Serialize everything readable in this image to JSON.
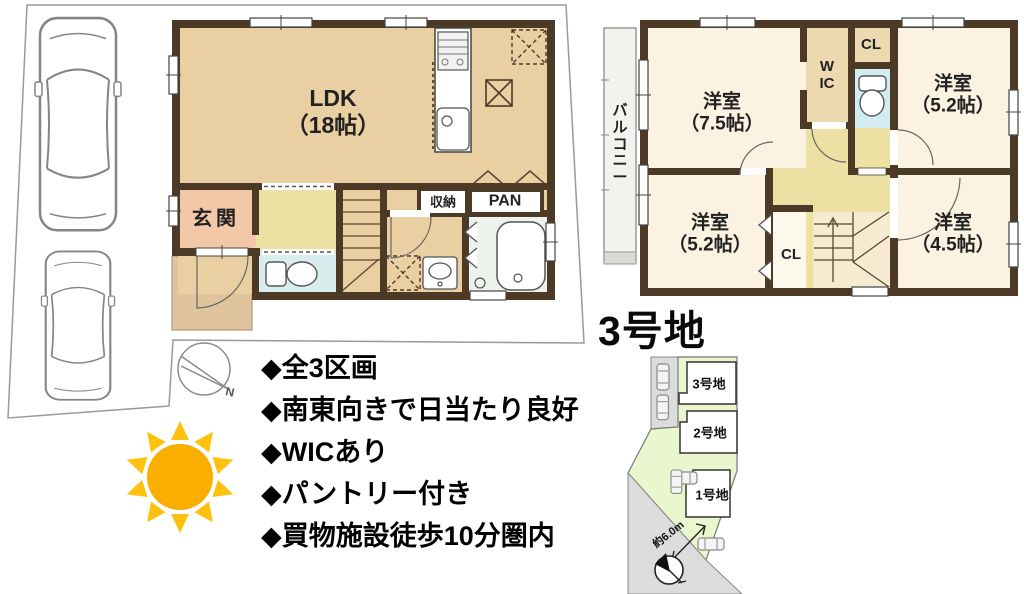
{
  "title": "3号地",
  "floor1": {
    "ldk_name": "LDK",
    "ldk_size": "（18帖）",
    "entrance": "玄関",
    "storage": "収納",
    "pantry": "PAN"
  },
  "floor2": {
    "balcony": "バルコニー",
    "wic": "WIC",
    "closet_top": "CL",
    "closet_bottom": "CL",
    "rooms": [
      {
        "name": "洋室",
        "size": "（7.5帖）"
      },
      {
        "name": "洋室",
        "size": "（5.2帖）"
      },
      {
        "name": "洋室",
        "size": "（5.2帖）"
      },
      {
        "name": "洋室",
        "size": "（4.5帖）"
      }
    ]
  },
  "features": [
    "◆全3区画",
    "◆南東向きで日当たり良好",
    "◆WICあり",
    "◆パントリー付き",
    "◆買物施設徒歩10分圏内"
  ],
  "site_map": {
    "plot_top": "3号地",
    "plot_middle": "2号地",
    "plot_bottom": "1号地",
    "road_width": "約6.0m"
  },
  "compass": {
    "north": "N"
  },
  "colors": {
    "wall": "#4c3a27",
    "ldk_floor": "#e9cfa2",
    "entrance_floor": "#f3c8a8",
    "porch": "#dfc49e",
    "hall_floor": "#ece0a2",
    "wet_floor": "#d8eeee",
    "room_floor": "#fbf2e1",
    "closet_floor": "#ecd9b0",
    "bath_floor": "#eef2ec",
    "sun_body": "#f9ae00",
    "sun_rays": "#ffc10e",
    "site_green": "#eaf6cd",
    "road_gray": "#dcdcdc"
  }
}
